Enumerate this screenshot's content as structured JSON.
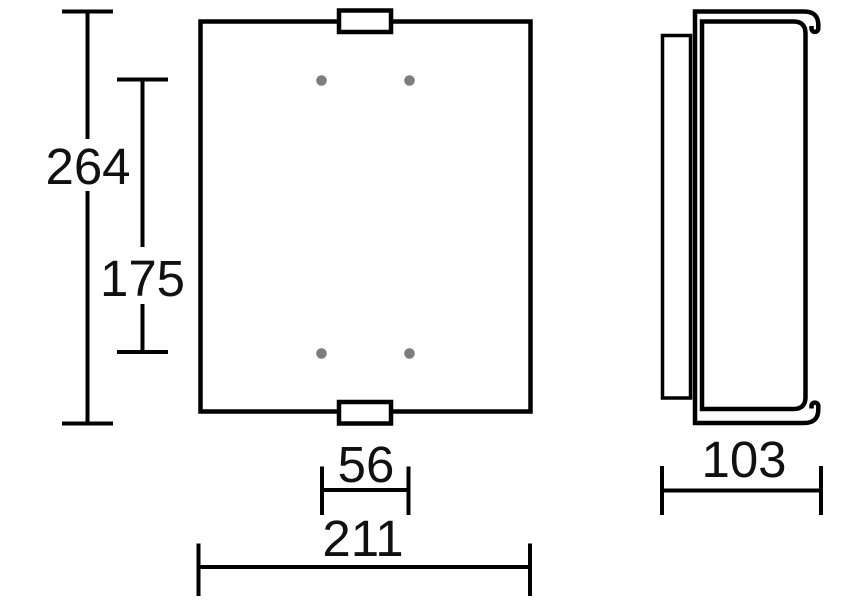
{
  "drawing": {
    "type": "technical-dimension-drawing",
    "views": {
      "front": "front-elevation",
      "side": "side-profile"
    },
    "colors": {
      "line": "#000000",
      "label_text": "#111111",
      "mounting_hole": "#7d7d7d",
      "background": "#ffffff"
    }
  },
  "dimensions": {
    "overall_height": "264",
    "hole_spacing_vertical": "175",
    "hole_spacing_horizontal": "56",
    "overall_width": "211",
    "depth": "103"
  }
}
